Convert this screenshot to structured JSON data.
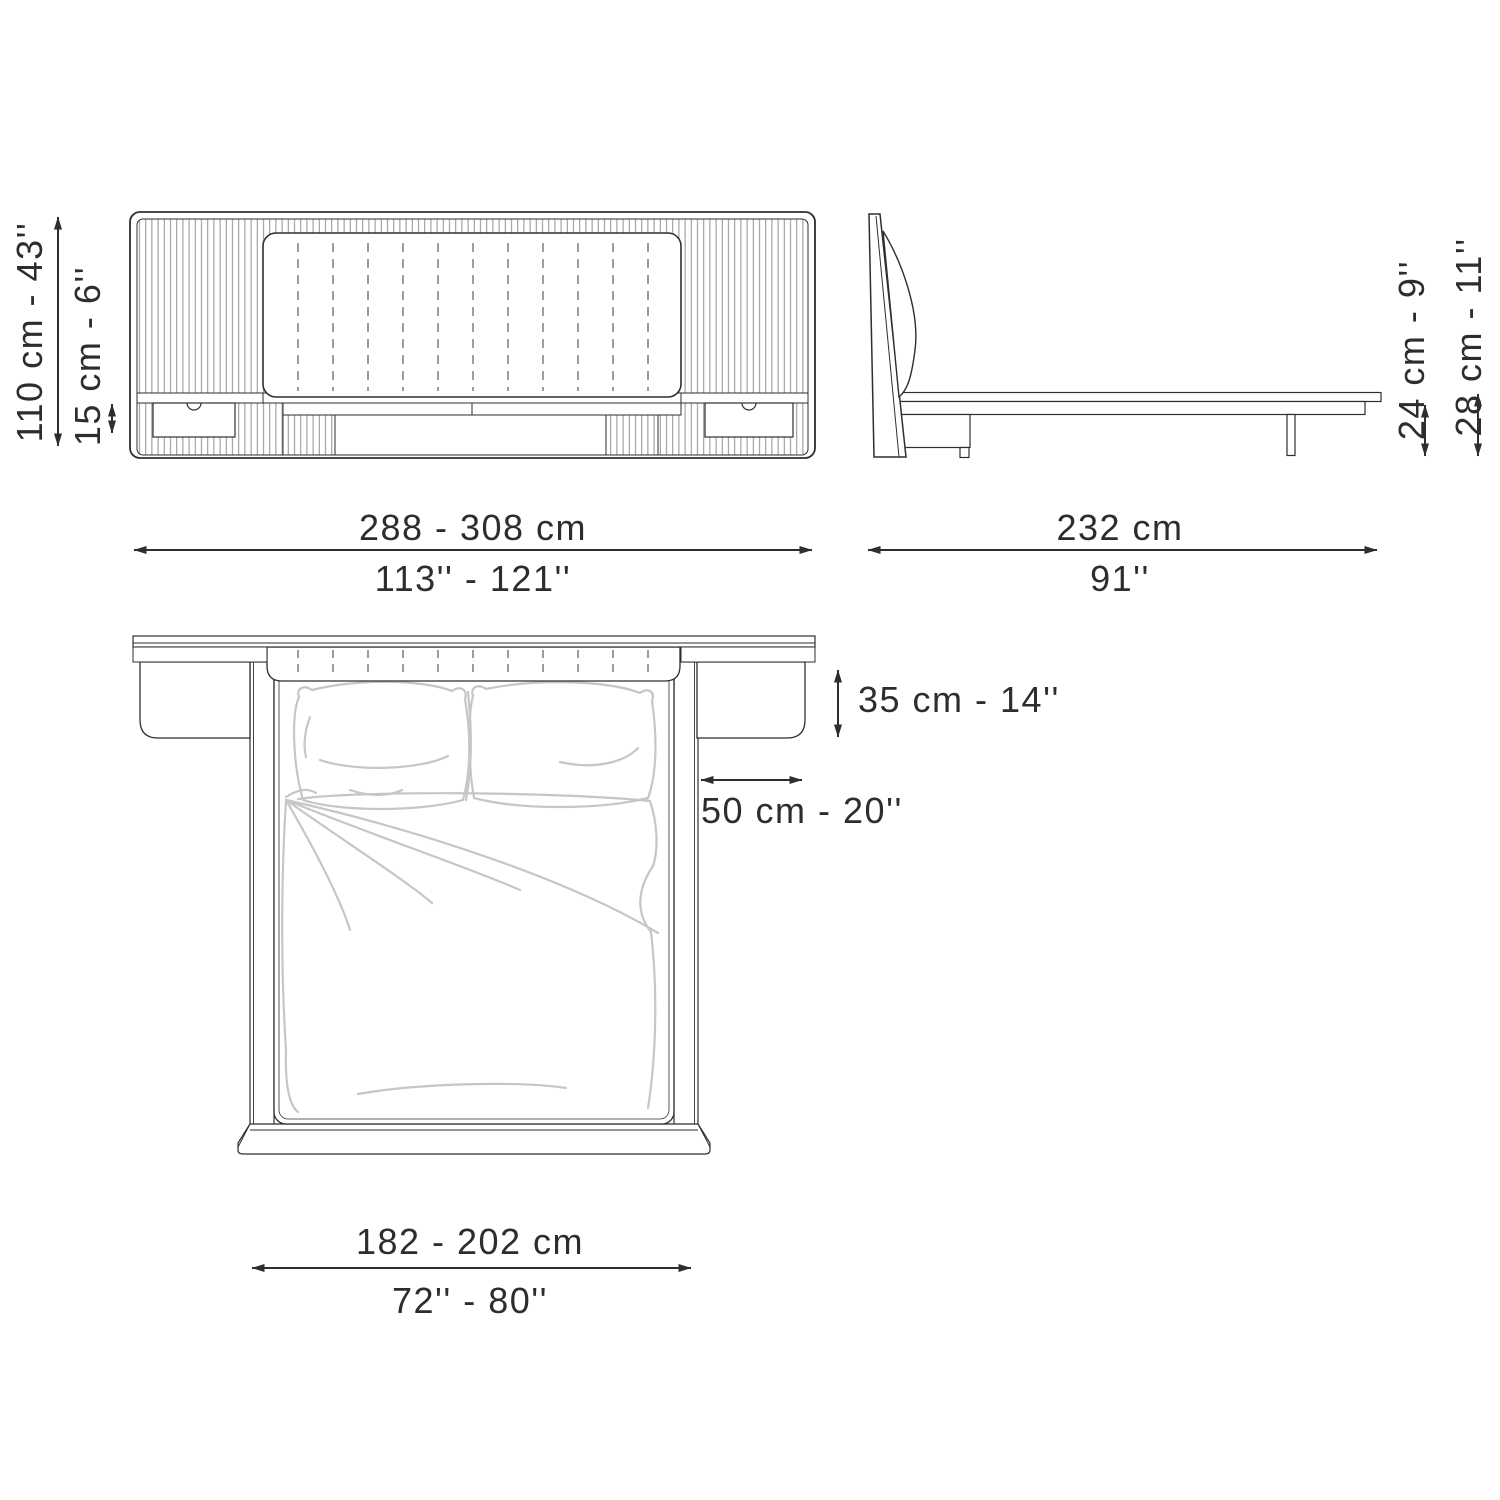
{
  "page": {
    "title": "Bed technical dimension drawing",
    "background": "#ffffff"
  },
  "colors": {
    "line": "#2e2e2e",
    "text": "#2d2d2d",
    "hatch": "#909090",
    "sketch": "#c6c6c6",
    "bg": "#ffffff"
  },
  "icons": {
    "dimension_arrow": "double-headed-arrow"
  },
  "views": {
    "front": {
      "name": "front elevation of bed with panel headboard, hanging nightstand drawers"
    },
    "side": {
      "name": "side elevation of bed with leaning headboard panel and platform"
    },
    "top": {
      "name": "plan view of bed with pillows, duvet and side shelves"
    }
  },
  "dimensions": {
    "front": {
      "height": "110 cm - 43''",
      "shelf": "15 cm - 6''",
      "width_cm": "288 - 308 cm",
      "width_in": "113'' - 121''"
    },
    "side": {
      "depth_cm": "232 cm",
      "depth_in": "91''",
      "platform_height": "24 cm - 9''",
      "frame_height": "28 cm - 11''"
    },
    "top": {
      "shelf_depth": "35 cm - 14''",
      "shelf_width": "50 cm - 20''",
      "width_cm": "182 - 202 cm",
      "width_in": "72'' - 80''"
    }
  }
}
